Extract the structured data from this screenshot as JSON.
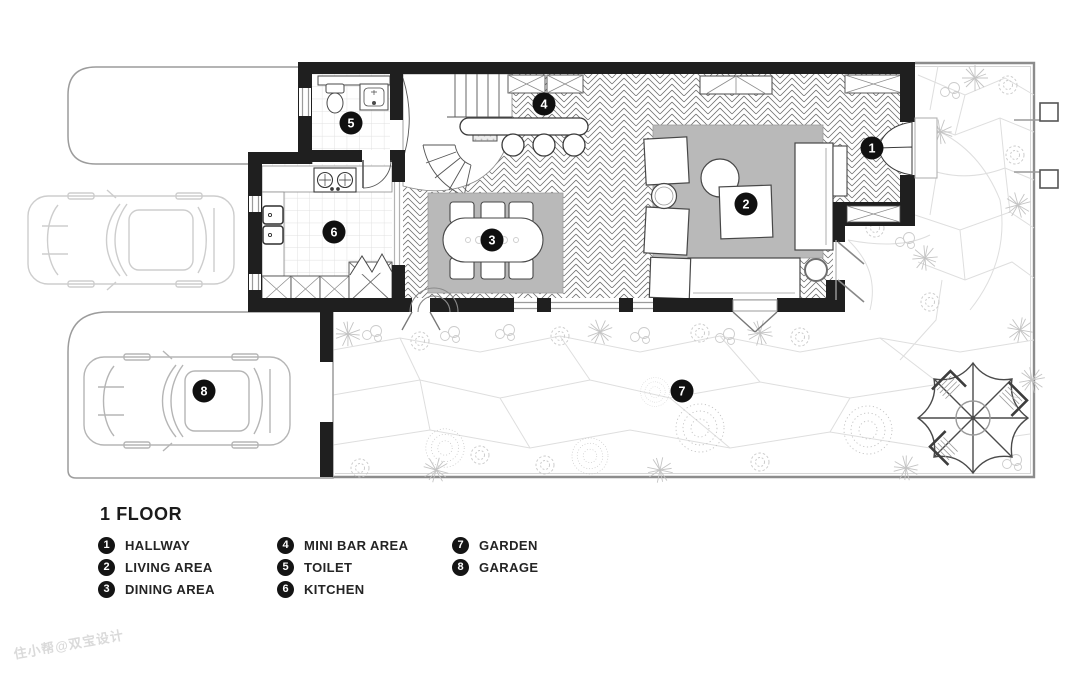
{
  "legend": {
    "title": "1 FLOOR",
    "items": [
      {
        "num": "1",
        "label": "HALLWAY"
      },
      {
        "num": "2",
        "label": "LIVING AREA"
      },
      {
        "num": "3",
        "label": "DINING AREA"
      },
      {
        "num": "4",
        "label": "MINI BAR AREA"
      },
      {
        "num": "5",
        "label": "TOILET"
      },
      {
        "num": "6",
        "label": "KITCHEN"
      },
      {
        "num": "7",
        "label": "GARDEN"
      },
      {
        "num": "8",
        "label": "GARAGE"
      }
    ]
  },
  "watermark": "住小帮@双宝设计",
  "colors": {
    "wall": "#1f1f1f",
    "rug": "#b9b9b9",
    "badge_bg": "#141414",
    "badge_text": "#ffffff",
    "light_outline": "#c9c9c9",
    "garden_line": "#dedede"
  }
}
